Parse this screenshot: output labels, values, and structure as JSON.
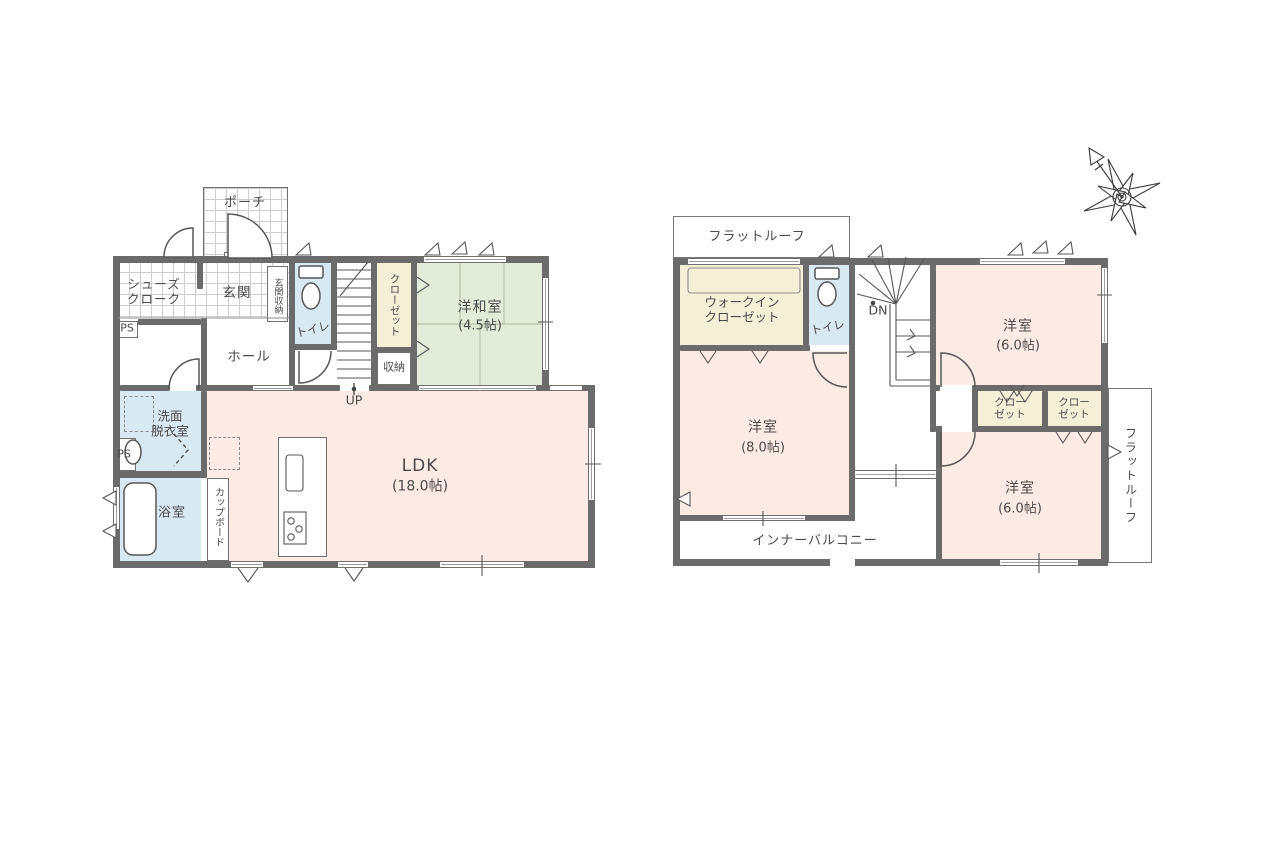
{
  "colors": {
    "wall": "#6b6b6b",
    "room_pink": "#fcebe5",
    "room_green": "#e3ecd8",
    "room_blue": "#d9e9f4",
    "closet_beige": "#f6efd8",
    "line": "#575757",
    "text": "#4a4a4a"
  },
  "floor1": {
    "porch": "ポーチ",
    "shoes_cloak": "シューズ\nクローク",
    "genkan": "玄関",
    "genkan_storage": "玄関収納",
    "toilet": "トイレ",
    "hall": "ホール",
    "closet": "クローゼット",
    "storage": "収納",
    "tatami_name": "洋和室",
    "tatami_size": "(4.5帖)",
    "up": "UP",
    "ps_upper": "PS",
    "ps_lower": "PS",
    "washroom": "洗面\n脱衣室",
    "bath": "浴室",
    "cupboard": "カップボード",
    "ldk_name": "LDK",
    "ldk_size": "(18.0帖)"
  },
  "floor2": {
    "flat_roof_top": "フラットルーフ",
    "wic": "ウォークイン\nクローゼット",
    "toilet": "トイレ",
    "dn": "DN",
    "bedroom_a_name": "洋室",
    "bedroom_a_size": "(6.0帖)",
    "closet_a": "クロー\nゼット",
    "closet_b": "クロー\nゼット",
    "bedroom_b_name": "洋室",
    "bedroom_b_size": "(8.0帖)",
    "bedroom_c_name": "洋室",
    "bedroom_c_size": "(6.0帖)",
    "inner_balcony": "インナーバルコニー",
    "flat_roof_right": "フラットルーフ"
  }
}
